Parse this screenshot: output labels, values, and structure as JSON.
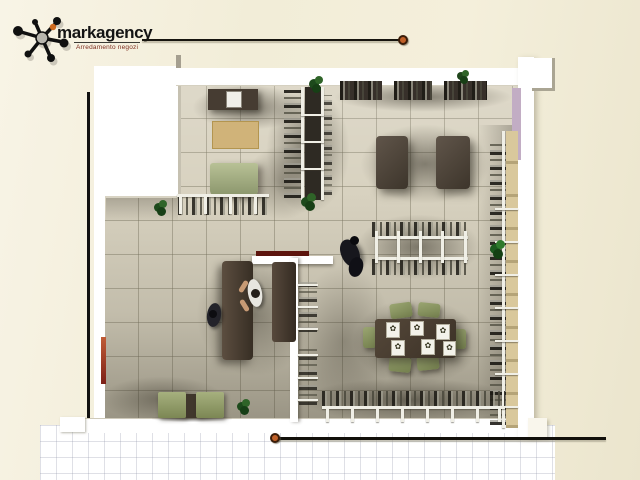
{
  "brand": {
    "name": "markagency",
    "tagline": "Arredamento negozi",
    "logo_icon": "ink-splat-icon"
  },
  "artwork": {
    "kind": "top-view 3D rendered retail shop floor plan",
    "palette": {
      "background": "#f2edd8",
      "floor_tile": "#d8d2c0",
      "walls": "#ffffff",
      "dark_wood": "#463c32",
      "olive_green": "#8f9a6a",
      "tan": "#d0b379",
      "lavender": "#c2adc4",
      "accent_orange": "#c06028",
      "rule_black": "#17150f"
    },
    "features": [
      "entrance-vestibule",
      "display-cabinet",
      "rug",
      "green-counter",
      "clothing-rack-top-left",
      "vertical-double-rack",
      "wall-shelves",
      "display-tables",
      "center-clothing-rack",
      "cash-desk",
      "staff-figure",
      "customer-figures",
      "display-dining-table-with-chairs",
      "place-settings",
      "right-wall-garment-rail",
      "bottom-garment-rail",
      "lounge-chairs",
      "side-table",
      "potted-plants",
      "tiled-floor",
      "fitting-area-lavender-wall"
    ]
  }
}
